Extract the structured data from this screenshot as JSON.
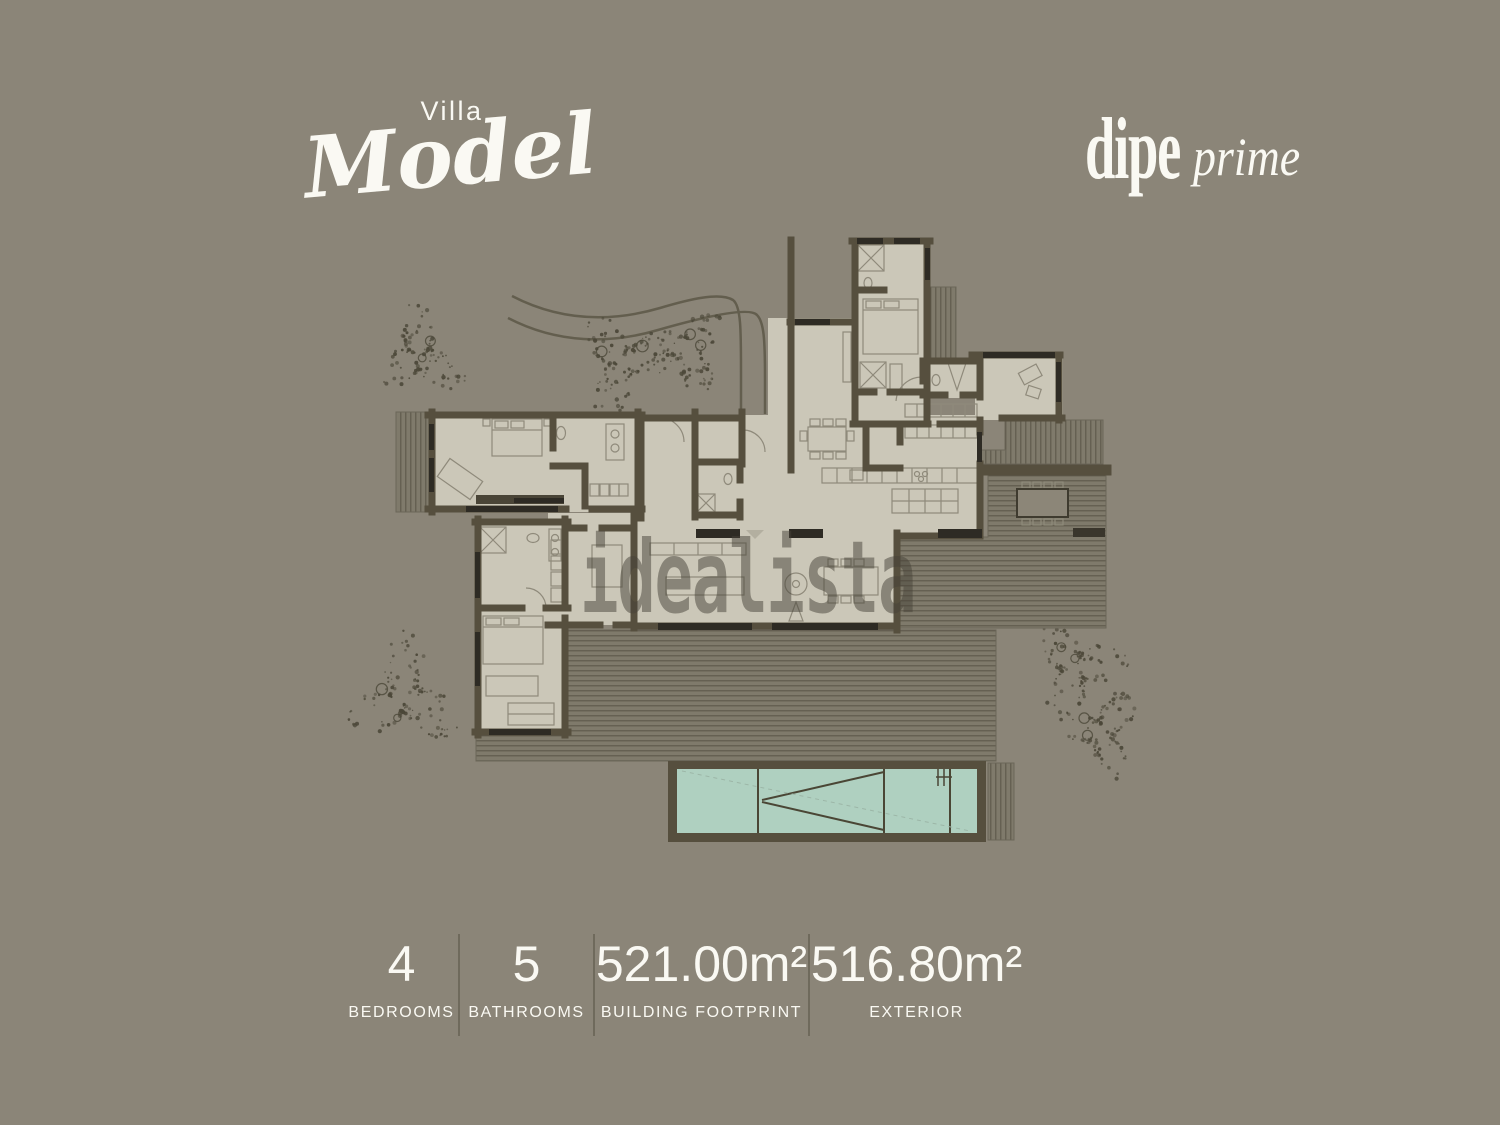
{
  "header": {
    "subtitle": "Villa",
    "title": "Model"
  },
  "brand": {
    "name": "dipe",
    "suffix": "prime"
  },
  "watermark": {
    "text": "idealista"
  },
  "stats": [
    {
      "value": "4",
      "label": "BEDROOMS"
    },
    {
      "value": "5",
      "label": "BATHROOMS"
    },
    {
      "value": "521.00m²",
      "label": "BUILDING FOOTPRINT"
    },
    {
      "value": "516.80m²",
      "label": "EXTERIOR"
    }
  ],
  "stat_column_widths": [
    113,
    135,
    215,
    215
  ],
  "colors": {
    "background": "#8b8578",
    "text": "#faf9f3",
    "divider": "#6f6a5c",
    "watermark": "rgba(70,66,56,0.5)",
    "floor": "#cbc7b8",
    "wall": "#564f3e",
    "wall_dark": "#2e2b24",
    "deck": "#7f7a6b",
    "deck_line": "#5c5749",
    "pool": "#afd0c0",
    "pool_line": "#4a4635",
    "tree": "#4b4738",
    "road": "#635e4e",
    "furniture": "#8f8a7b"
  },
  "plan": {
    "type": "villa-floor-plan",
    "trees": [
      {
        "cx": 418,
        "cy": 356,
        "r": 40
      },
      {
        "cx": 622,
        "cy": 362,
        "r": 42
      },
      {
        "cx": 688,
        "cy": 350,
        "r": 36
      },
      {
        "cx": 404,
        "cy": 696,
        "r": 48
      },
      {
        "cx": 1076,
        "cy": 668,
        "r": 42
      },
      {
        "cx": 1102,
        "cy": 732,
        "r": 36
      }
    ]
  }
}
